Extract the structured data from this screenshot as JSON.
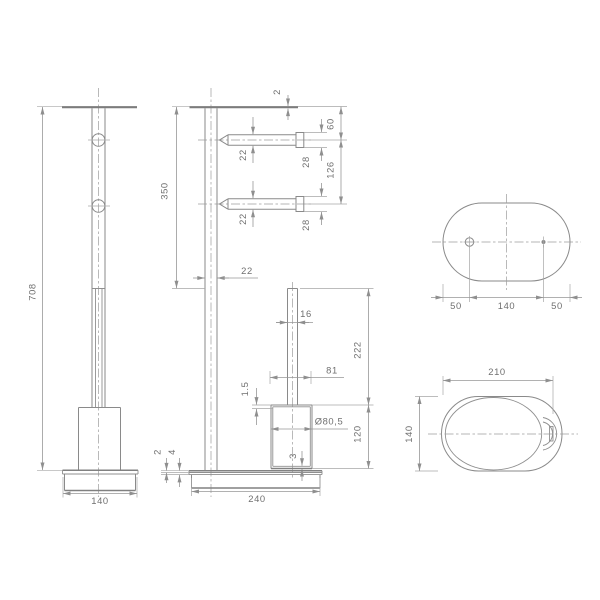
{
  "drawing": {
    "side_view": {
      "overall_height": "708",
      "base_width": "140"
    },
    "front_view": {
      "top_plate_thickness": "2",
      "upper_post_length": "350",
      "post_diameter": "22",
      "top_to_arm": "60",
      "arm1_diameter": "22",
      "arm1_end_diameter": "28",
      "arm_spacing": "126",
      "arm2_diameter": "22",
      "arm2_end_diameter": "28",
      "holder_pole_diameter": "16",
      "holder_height": "222",
      "cup_rim_width": "81",
      "cup_wall_thickness": "1.5",
      "cup_diameter": "Ø80,5",
      "cup_height": "120",
      "cup_base_thickness": "3",
      "base_skin_thickness": "2",
      "base_plate_thickness": "4",
      "base_length": "240"
    },
    "base_top_view": {
      "left_offset": "50",
      "hole_spacing": "140",
      "right_offset": "50"
    },
    "tray_top_view": {
      "width": "210",
      "depth": "140"
    }
  }
}
